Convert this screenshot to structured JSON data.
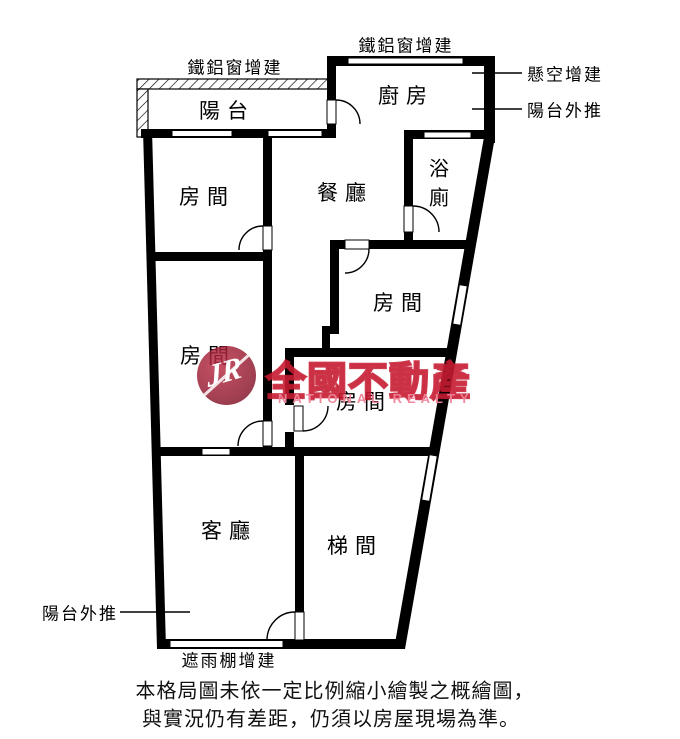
{
  "colors": {
    "wall": "#000000",
    "window": "#ffffff",
    "watermark_red": "#c61a30",
    "watermark_pink": "#f08398"
  },
  "rooms": {
    "balcony": "陽台",
    "kitchen": "廚房",
    "dining": "餐廳",
    "bathroom": "浴廁",
    "bedroom": "房間",
    "living": "客廳",
    "stairwell": "梯間"
  },
  "annotations": {
    "aluminum_window_left": "鐵鋁窗增建",
    "aluminum_window_top": "鐵鋁窗增建",
    "suspended_addition": "懸空增建",
    "balcony_pushout_right": "陽台外推",
    "balcony_pushout_left": "陽台外推",
    "rain_canopy": "遮雨棚增建"
  },
  "watermark": {
    "logo": "JR",
    "brand": "全國不動產",
    "brand_en": "NATIONAL REALTY"
  },
  "caption": {
    "line1": "本格局圖未依一定比例縮小繪製之概繪圖，",
    "line2": "與實況仍有差距，仍須以房屋現場為準。"
  }
}
